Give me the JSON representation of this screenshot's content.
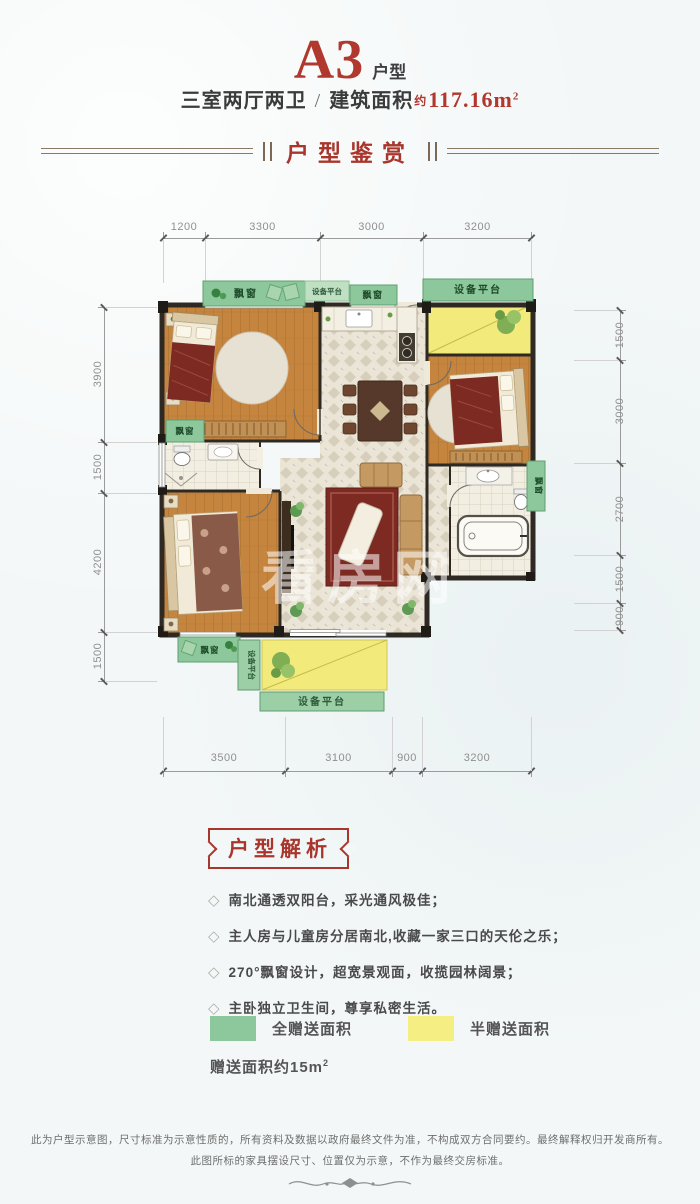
{
  "header": {
    "unit": "A3",
    "unit_suffix": "户型",
    "rooms": "三室两厅两卫",
    "sep": "/",
    "area_label": "建筑面积",
    "approx": "约",
    "area_value": "117.16m",
    "area_sup": "2",
    "section_title": "户型鉴赏",
    "accent_color": "#a8362c"
  },
  "plan": {
    "dims_top": [
      "1200",
      "3300",
      "3000",
      "3200"
    ],
    "dims_left": [
      "3900",
      "1500",
      "4200",
      "1500"
    ],
    "dims_right": [
      "1500",
      "3000",
      "2700",
      "1500",
      "900"
    ],
    "dims_bottom": [
      "3500",
      "3100",
      "900",
      "3200"
    ],
    "labels": {
      "bay_window": "飘窗",
      "equipment": "设备平台"
    },
    "watermark": "看房网",
    "full_gift_color": "#8dc89c",
    "half_gift_color": "#f2eb7c"
  },
  "analysis": {
    "title": "户型解析",
    "bullet_icon": "◇",
    "bullets": [
      "南北通透双阳台，采光通风极佳；",
      "主人房与儿童房分居南北,收藏一家三口的天伦之乐；",
      "270°飘窗设计，超宽景观面，收揽园林阔景；",
      "主卧独立卫生间，尊享私密生活。"
    ]
  },
  "legend": {
    "full_label": "全赠送面积",
    "half_label": "半赠送面积",
    "full_color": "#8dc89c",
    "half_color": "#f5ee82",
    "note": "赠送面积约15m",
    "note_sup": "2"
  },
  "footer": {
    "line1": "此为户型示意图，尺寸标准为示意性质的，所有资料及数据以政府最终文件为准，不构成双方合同要约。最终解释权归开发商所有。",
    "line2": "此图所标的家具摆设尺寸、位置仅为示意，不作为最终交房标准。"
  }
}
